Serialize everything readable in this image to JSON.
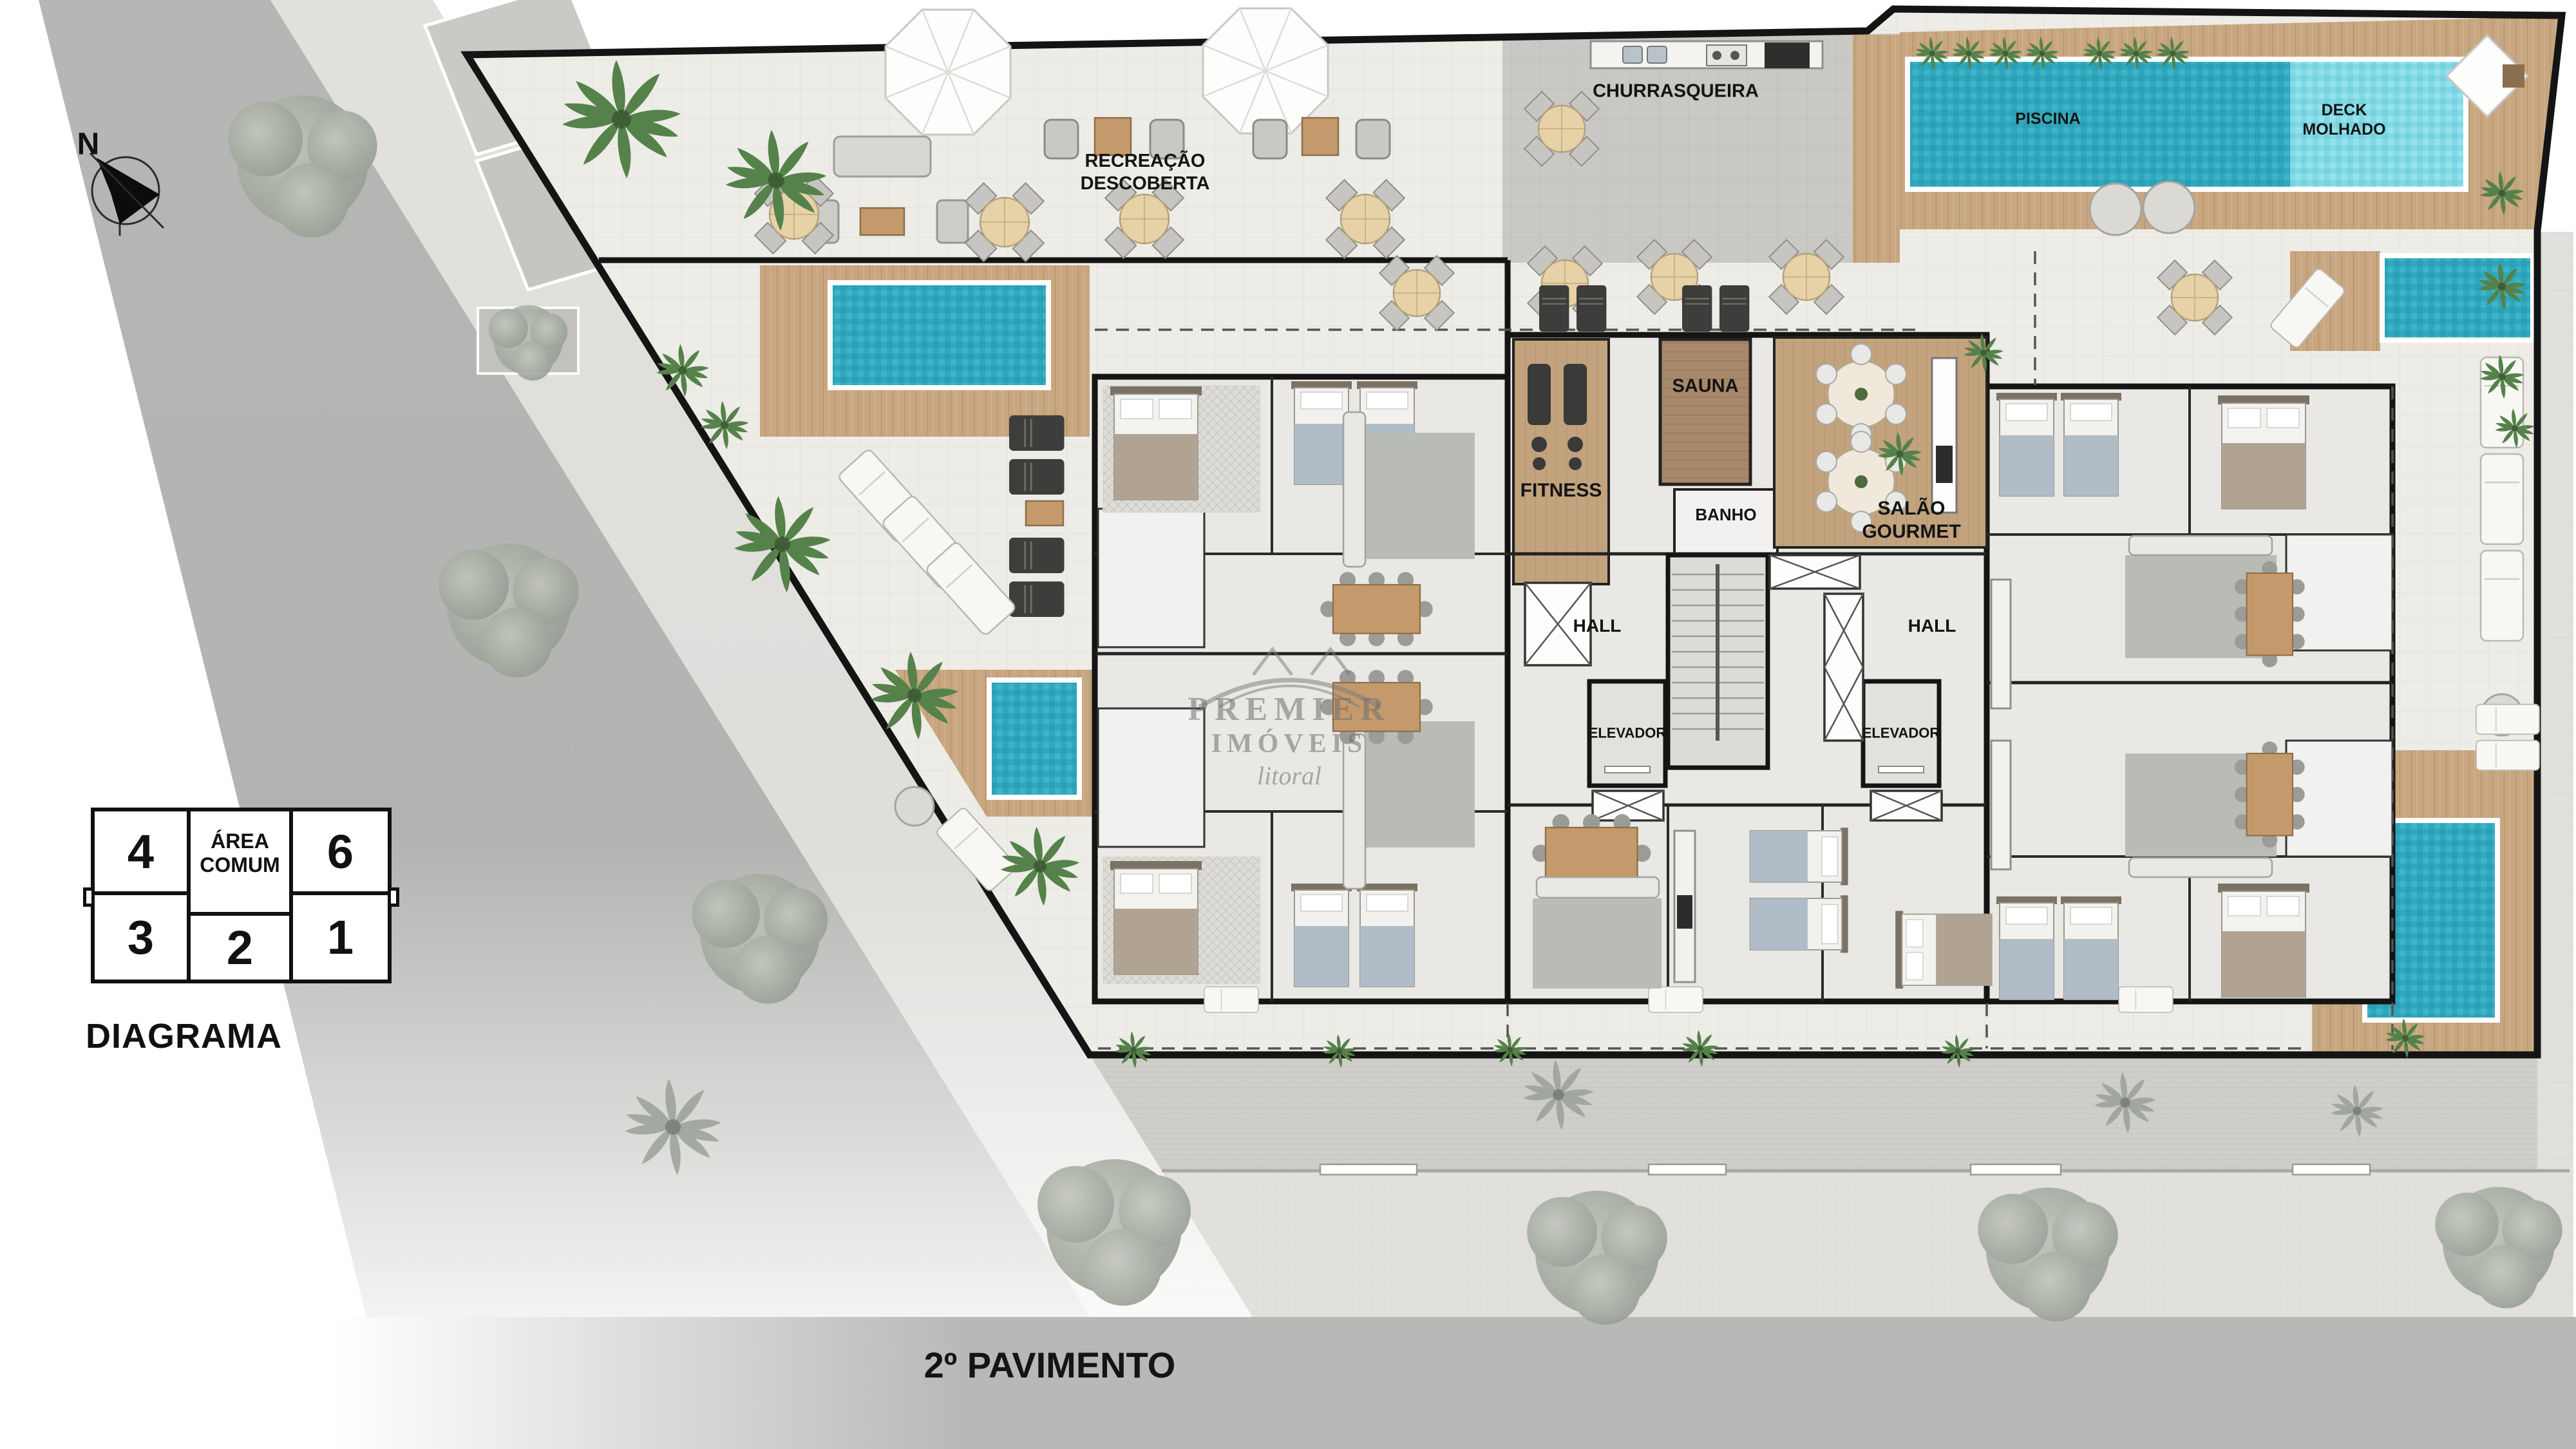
{
  "page": {
    "title": "2º PAVIMENTO"
  },
  "compass": {
    "label": "N"
  },
  "areas": {
    "recreacao_line1": "RECREAÇÃO",
    "recreacao_line2": "DESCOBERTA",
    "churrasqueira": "CHURRASQUEIRA",
    "piscina": "PISCINA",
    "deck_molhado_line1": "DECK",
    "deck_molhado_line2": "MOLHADO",
    "sauna": "SAUNA",
    "fitness": "FITNESS",
    "banho": "BANHO",
    "salao_line1": "SALÃO",
    "salao_line2": "GOURMET",
    "hall_left": "HALL",
    "hall_right": "HALL",
    "elevador_left": "ELEVADOR",
    "elevador_right": "ELEVADOR"
  },
  "legend": {
    "title": "DIAGRAMA",
    "cells": [
      {
        "id": "unit-4",
        "label": "4"
      },
      {
        "id": "area-comum",
        "label_line1": "ÁREA",
        "label_line2": "COMUM"
      },
      {
        "id": "unit-6",
        "label": "6"
      },
      {
        "id": "unit-3",
        "label": "3"
      },
      {
        "id": "unit-2",
        "label": "2"
      },
      {
        "id": "unit-1",
        "label": "1"
      }
    ]
  },
  "footer": {
    "floor_label": "2º PAVIMENTO"
  },
  "watermark": {
    "line1": "PREMIER",
    "line2": "IMÓVEIS",
    "line3": "litoral"
  },
  "colors": {
    "water_dark": "#2fa7bc",
    "water_light": "#82d9e5",
    "wood_deck": "#c8a67f",
    "street": "#b6b6b4",
    "plan_floor": "#edece7",
    "churrasqueira_floor": "#c9c8c4",
    "accent_green": "#55824a"
  }
}
